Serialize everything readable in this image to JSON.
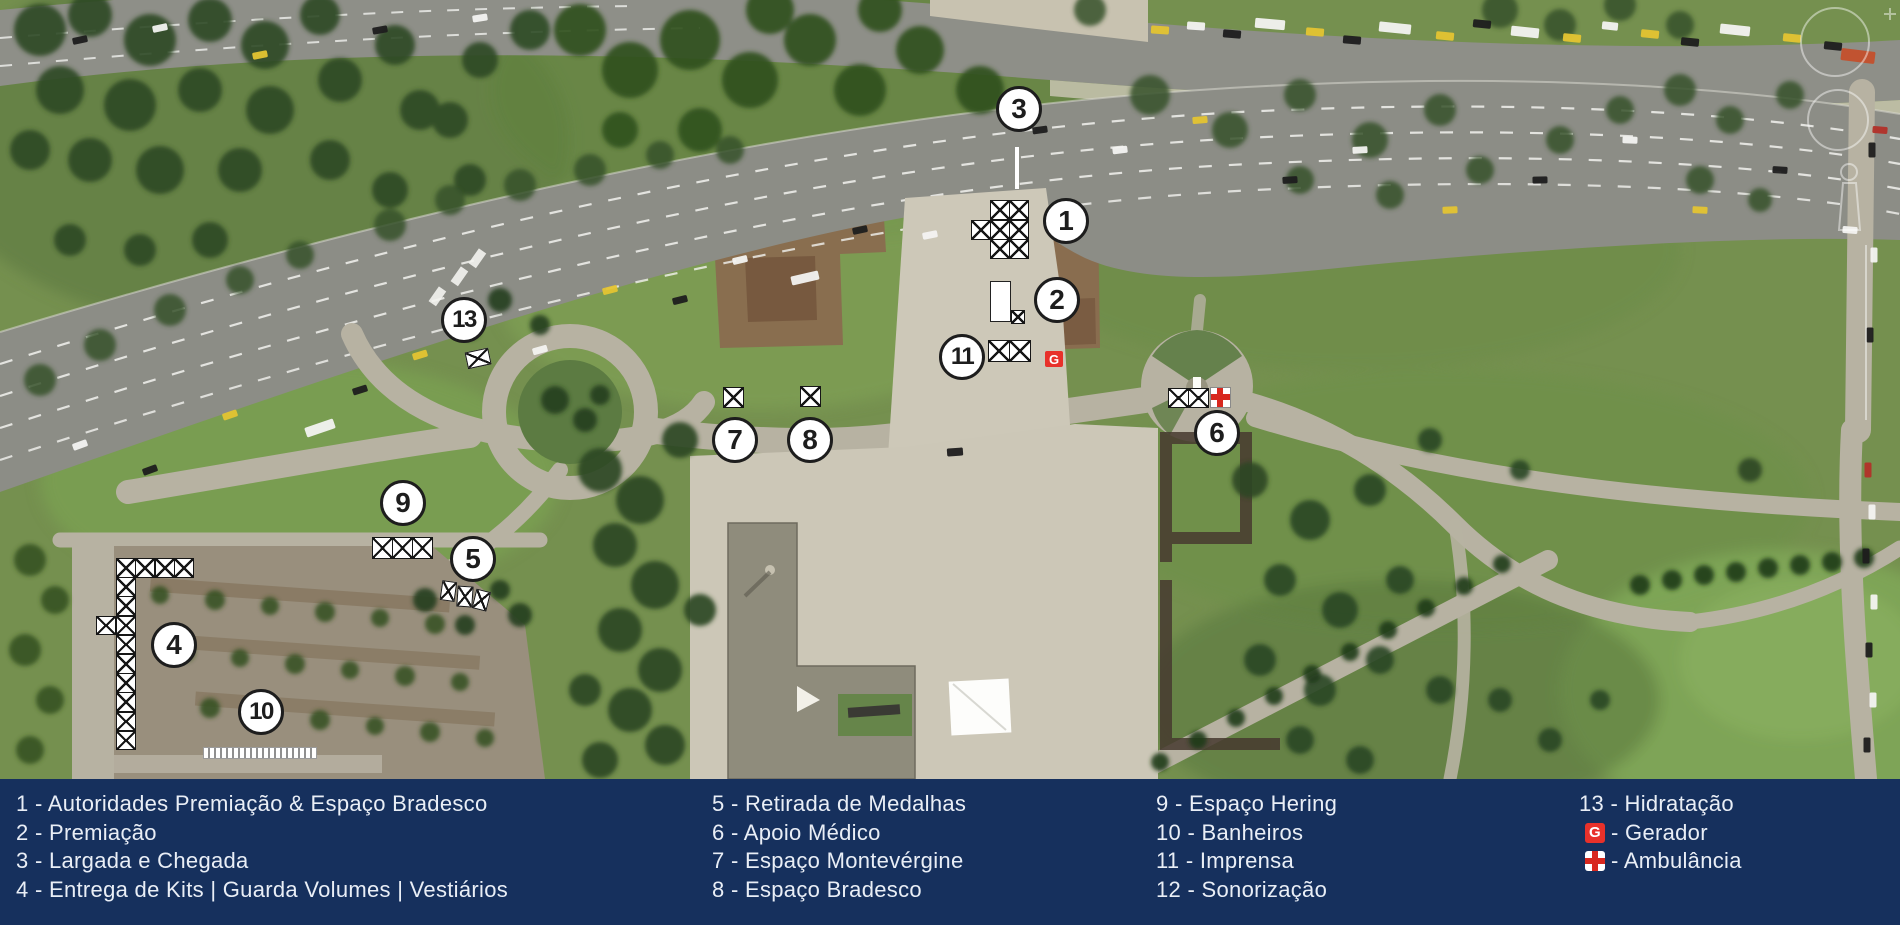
{
  "legend": {
    "background": "#16305d",
    "text_color": "#e9eef6",
    "separator": " - ",
    "columns": [
      {
        "items": [
          {
            "marker": "1",
            "label": "Autoridades Premiação & Espaço Bradesco"
          },
          {
            "marker": "2",
            "label": "Premiação"
          },
          {
            "marker": "3",
            "label": "Largada e Chegada"
          },
          {
            "marker": "4",
            "label": "Entrega de Kits | Guarda Volumes | Vestiários"
          }
        ]
      },
      {
        "items": [
          {
            "marker": "5",
            "label": "Retirada de Medalhas"
          },
          {
            "marker": "6",
            "label": "Apoio Médico"
          },
          {
            "marker": "7",
            "label": "Espaço Montevérgine"
          },
          {
            "marker": "8",
            "label": "Espaço Bradesco"
          }
        ]
      },
      {
        "items": [
          {
            "marker": "9",
            "label": "Espaço Hering"
          },
          {
            "marker": "10",
            "label": "Banheiros"
          },
          {
            "marker": "11",
            "label": "Imprensa"
          },
          {
            "marker": "12",
            "label": "Sonorização"
          }
        ]
      },
      {
        "items": [
          {
            "marker": "13",
            "label": "Hidratação"
          },
          {
            "icon": "gerador-icon",
            "label": "Gerador"
          },
          {
            "icon": "ambulancia-icon",
            "label": "Ambulância"
          }
        ]
      }
    ]
  },
  "map": {
    "gerador_letter": "G",
    "accent_red": "#e8312a",
    "markers": [
      {
        "n": "3",
        "x": 1019,
        "y": 109
      },
      {
        "n": "1",
        "x": 1066,
        "y": 221
      },
      {
        "n": "2",
        "x": 1057,
        "y": 300
      },
      {
        "n": "13",
        "x": 464,
        "y": 320
      },
      {
        "n": "11",
        "x": 962,
        "y": 357
      },
      {
        "n": "7",
        "x": 735,
        "y": 440
      },
      {
        "n": "8",
        "x": 810,
        "y": 440
      },
      {
        "n": "6",
        "x": 1217,
        "y": 433
      },
      {
        "n": "9",
        "x": 403,
        "y": 503
      },
      {
        "n": "5",
        "x": 473,
        "y": 559
      },
      {
        "n": "4",
        "x": 174,
        "y": 645
      },
      {
        "n": "10",
        "x": 261,
        "y": 712
      }
    ],
    "structures": [
      {
        "id": "largada-start-line",
        "type": "whiteline",
        "x": 1015,
        "y": 147,
        "w": 4,
        "h": 42
      },
      {
        "id": "autoridades-tents",
        "type": "xgrid",
        "x": 971,
        "y": 200,
        "cw": 19,
        "ch": 19.5,
        "cells": [
          [
            1,
            0
          ],
          [
            2,
            0
          ],
          [
            0,
            1
          ],
          [
            1,
            1
          ],
          [
            2,
            1
          ],
          [
            1,
            2
          ],
          [
            2,
            2
          ]
        ]
      },
      {
        "id": "premiacao-stage",
        "type": "rect",
        "x": 990,
        "y": 281,
        "w": 21,
        "h": 41
      },
      {
        "id": "premiacao-tent",
        "type": "xgrid",
        "x": 1011,
        "y": 310,
        "cw": 13,
        "ch": 13,
        "cells": [
          [
            0,
            0
          ]
        ]
      },
      {
        "id": "imprensa-tents",
        "type": "xgrid",
        "x": 988,
        "y": 340,
        "cw": 21,
        "ch": 21,
        "cells": [
          [
            0,
            0
          ],
          [
            1,
            0
          ]
        ]
      },
      {
        "id": "gerador-box",
        "type": "gbox",
        "x": 1045,
        "y": 351,
        "w": 18,
        "h": 16
      },
      {
        "id": "hidratacao-tent",
        "type": "xgrid",
        "x": 466,
        "y": 350,
        "cw": 23,
        "ch": 16,
        "cells": [
          [
            0,
            0
          ]
        ],
        "rot": -12
      },
      {
        "id": "montevergine-tent",
        "type": "xgrid",
        "x": 723,
        "y": 387,
        "cw": 20,
        "ch": 20,
        "cells": [
          [
            0,
            0
          ]
        ]
      },
      {
        "id": "bradesco-tent",
        "type": "xgrid",
        "x": 800,
        "y": 386,
        "cw": 20,
        "ch": 20,
        "cells": [
          [
            0,
            0
          ]
        ]
      },
      {
        "id": "apoio-medico-tents",
        "type": "xgrid",
        "x": 1168,
        "y": 388,
        "cw": 20,
        "ch": 19.5,
        "cells": [
          [
            0,
            0
          ],
          [
            1,
            0
          ]
        ]
      },
      {
        "id": "ambulancia-box",
        "type": "crossbox",
        "x": 1210,
        "y": 387,
        "w": 21,
        "h": 21
      },
      {
        "id": "hering-tents",
        "type": "xgrid",
        "x": 372,
        "y": 537,
        "cw": 20,
        "ch": 21,
        "cells": [
          [
            0,
            0
          ],
          [
            1,
            0
          ],
          [
            2,
            0
          ]
        ]
      },
      {
        "id": "medalhas-tent-a",
        "type": "xgrid",
        "x": 441,
        "y": 581,
        "cw": 14,
        "ch": 19,
        "cells": [
          [
            0,
            0
          ]
        ],
        "rot": 8
      },
      {
        "id": "medalhas-tent-b",
        "type": "xgrid",
        "x": 457,
        "y": 586,
        "cw": 15,
        "ch": 20,
        "cells": [
          [
            0,
            0
          ]
        ],
        "rot": 4
      },
      {
        "id": "medalhas-tent-c",
        "type": "xgrid",
        "x": 474,
        "y": 590,
        "cw": 14,
        "ch": 19,
        "cells": [
          [
            0,
            0
          ]
        ],
        "rot": 14
      },
      {
        "id": "entrega-kits-tents",
        "type": "xgrid",
        "x": 96,
        "y": 558,
        "cw": 19.5,
        "ch": 19.2,
        "cells": [
          [
            1,
            0
          ],
          [
            2,
            0
          ],
          [
            3,
            0
          ],
          [
            4,
            0
          ],
          [
            1,
            1
          ],
          [
            1,
            2
          ],
          [
            0,
            3
          ],
          [
            1,
            3
          ],
          [
            1,
            4
          ],
          [
            1,
            5
          ],
          [
            1,
            6
          ],
          [
            1,
            7
          ],
          [
            1,
            8
          ],
          [
            1,
            9
          ]
        ]
      },
      {
        "id": "banheiros-row",
        "type": "stripbar",
        "x": 203,
        "y": 747,
        "w": 114,
        "h": 12
      }
    ]
  }
}
